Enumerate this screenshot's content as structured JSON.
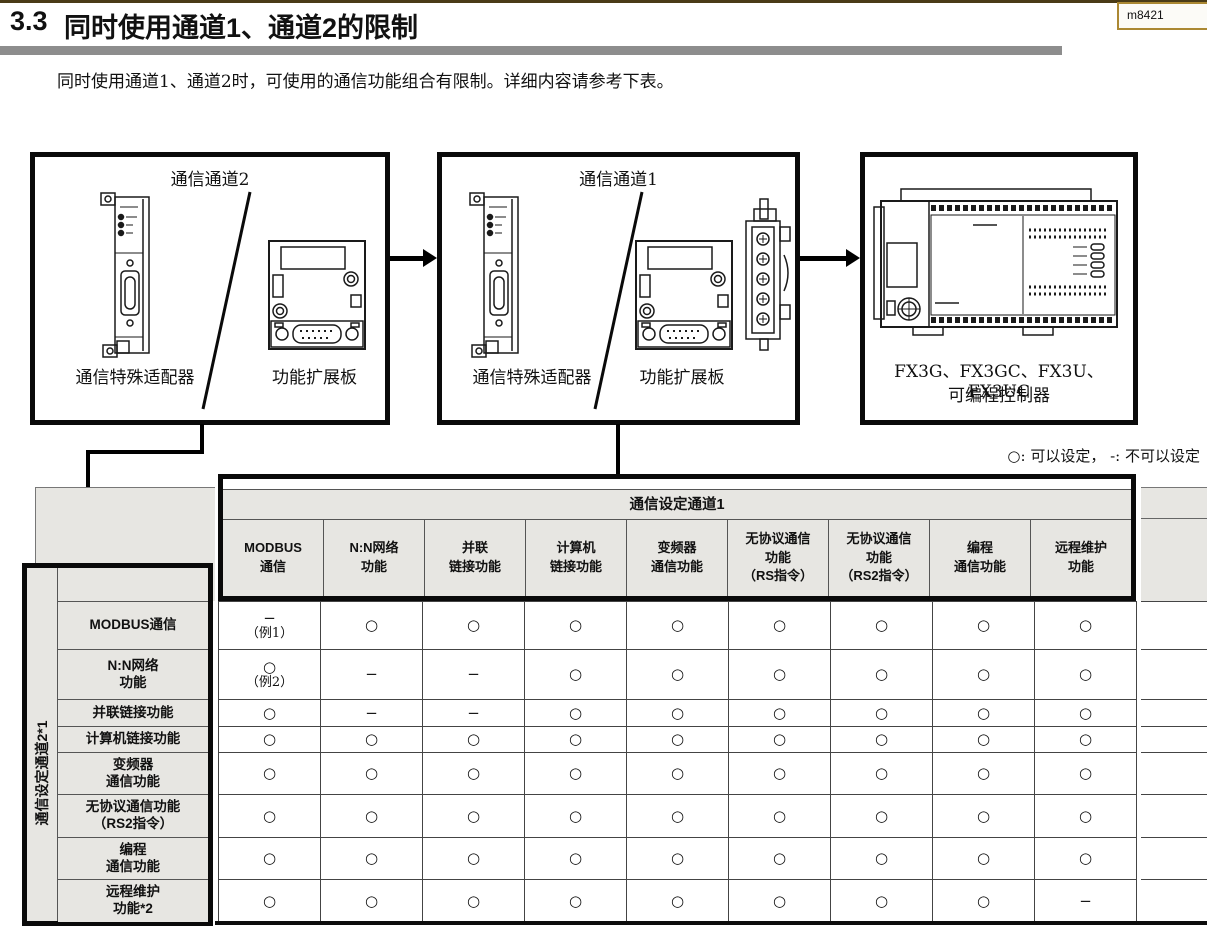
{
  "page": {
    "section_number": "3.3",
    "section_title": "同时使用通道1、通道2的限制",
    "bookmark": "m8421",
    "intro": "同时使用通道1、通道2时，可使用的通信功能组合有限制。详细内容请参考下表。"
  },
  "diagram": {
    "channel2": {
      "title": "通信通道2",
      "adapter_label": "通信特殊适配器",
      "board_label": "功能扩展板"
    },
    "channel1": {
      "title": "通信通道1",
      "adapter_label": "通信特殊适配器",
      "board_label": "功能扩展板"
    },
    "plc": {
      "models": "FX3G、FX3GC、FX3U、FX3UC",
      "label": "可编程控制器"
    }
  },
  "legend": {
    "text": "○: 可以设定， -: 不可以设定"
  },
  "table": {
    "column_group_title": "通信设定通道1",
    "row_group_title": "通信设定通道2*1",
    "columns": [
      [
        "MODBUS",
        "通信"
      ],
      [
        "N:N网络",
        "功能"
      ],
      [
        "并联",
        "链接功能"
      ],
      [
        "计算机",
        "链接功能"
      ],
      [
        "变频器",
        "通信功能"
      ],
      [
        "无协议通信",
        "功能",
        "（RS指令）"
      ],
      [
        "无协议通信",
        "功能",
        "（RS2指令）"
      ],
      [
        "编程",
        "通信功能"
      ],
      [
        "远程维护",
        "功能"
      ]
    ],
    "rows": [
      {
        "label": [
          "MODBUS通信"
        ],
        "cells": [
          [
            "−",
            "（例1）"
          ],
          "○",
          "○",
          "○",
          "○",
          "○",
          "○",
          "○",
          "○"
        ]
      },
      {
        "label": [
          "N:N网络",
          "功能"
        ],
        "cells": [
          [
            "○",
            "（例2）"
          ],
          "−",
          "−",
          "○",
          "○",
          "○",
          "○",
          "○",
          "○"
        ]
      },
      {
        "label": [
          "并联链接功能"
        ],
        "cells": [
          "○",
          "−",
          "−",
          "○",
          "○",
          "○",
          "○",
          "○",
          "○"
        ]
      },
      {
        "label": [
          "计算机链接功能"
        ],
        "cells": [
          "○",
          "○",
          "○",
          "○",
          "○",
          "○",
          "○",
          "○",
          "○"
        ]
      },
      {
        "label": [
          "变频器",
          "通信功能"
        ],
        "cells": [
          "○",
          "○",
          "○",
          "○",
          "○",
          "○",
          "○",
          "○",
          "○"
        ]
      },
      {
        "label": [
          "无协议通信功能",
          "（RS2指令）"
        ],
        "cells": [
          "○",
          "○",
          "○",
          "○",
          "○",
          "○",
          "○",
          "○",
          "○"
        ]
      },
      {
        "label": [
          "编程",
          "通信功能"
        ],
        "cells": [
          "○",
          "○",
          "○",
          "○",
          "○",
          "○",
          "○",
          "○",
          "○"
        ]
      },
      {
        "label": [
          "远程维护",
          "功能*2"
        ],
        "cells": [
          "○",
          "○",
          "○",
          "○",
          "○",
          "○",
          "○",
          "○",
          "−"
        ]
      }
    ]
  },
  "colors": {
    "thick_border": "#0a0a0a",
    "grid_line": "#444444",
    "header_bg": "#e7e6e2",
    "title_rule": "#8d8d8d",
    "bookmark_border": "#ab8833"
  }
}
